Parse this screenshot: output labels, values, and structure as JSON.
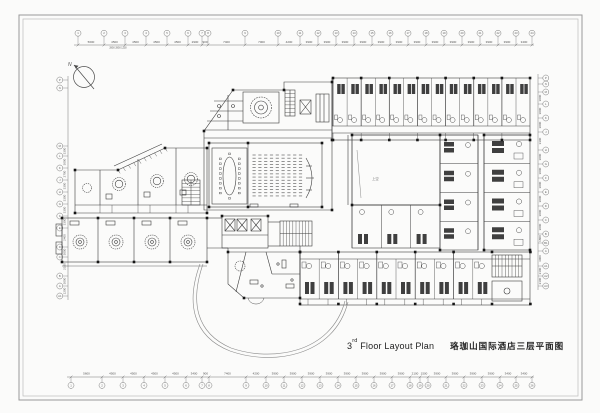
{
  "title": {
    "en_num": "3",
    "en_sup": "rd",
    "en_rest": " Floor Layout Plan",
    "cn": "珞珈山国际酒店三层平面图"
  },
  "north": {
    "label": "N"
  },
  "labels": {
    "atrium": "上空",
    "sub_dims": "2850 2850 1250"
  },
  "colors": {
    "line": "#3d3d3d",
    "dim": "#666666",
    "frame": "#9a9a9a",
    "bed": "#3f3f3f"
  },
  "grids": {
    "top_labels": [
      "1",
      "2",
      "3",
      "4",
      "5",
      "6",
      "7",
      "8",
      "9",
      "10",
      "11",
      "12",
      "13",
      "14",
      "15",
      "16",
      "17",
      "18",
      "19",
      "20",
      "21",
      "22",
      "23",
      "24"
    ],
    "bottom_labels": [
      "1",
      "2",
      "3",
      "4",
      "5",
      "6",
      "7",
      "8",
      "9",
      "10",
      "11",
      "12",
      "13",
      "14",
      "15",
      "16",
      "17",
      "18",
      "19",
      "20",
      "21",
      "22",
      "23",
      "24",
      "25",
      "26"
    ],
    "left_labels": [
      "P",
      "N",
      "M",
      "L",
      "K",
      "J",
      "H",
      "G",
      "F",
      "E",
      "D",
      "C",
      "B",
      "A",
      "A1"
    ],
    "right_labels": [
      "P",
      "N",
      "M",
      "L",
      "K",
      "J",
      "H",
      "G",
      "F",
      "E",
      "D",
      "C",
      "B",
      "B1",
      "A",
      "A1",
      "A2",
      "A3"
    ]
  },
  "dimensions": {
    "top": [
      "5600",
      "4500",
      "4500",
      "4500",
      "4500",
      "2900",
      "900",
      "7400",
      "7000",
      "4200",
      "3900",
      "3900",
      "3900",
      "3900",
      "3900",
      "3900",
      "3900",
      "3900",
      "3900",
      "3900",
      "3900",
      "3900",
      "3400"
    ],
    "bottom": [
      "5600",
      "4500",
      "4500",
      "4500",
      "4500",
      "3400",
      "900",
      "7400",
      "4200",
      "3900",
      "3900",
      "3900",
      "3900",
      "3900",
      "3900",
      "3900",
      "3900",
      "2100",
      "1500",
      "3900",
      "3900",
      "3900",
      "3900",
      "3400",
      "3400"
    ],
    "left": [
      "",
      "",
      "3300",
      "3000",
      "2700",
      "3300",
      "3300",
      "3300",
      "3300",
      "2400",
      "3000",
      "2100",
      "3000",
      "1200"
    ],
    "right": [
      "",
      "",
      "3000",
      "3000",
      "3000",
      "3300",
      "3000",
      "3000",
      "3000",
      "3000",
      "3000",
      "3000",
      "1800",
      "",
      "3000",
      "2100",
      "2100"
    ]
  },
  "rooms": {
    "top_row_modules": 7,
    "bottom_row_modules": 5,
    "right_wing_modules": 4,
    "mid_wing_modules": 4,
    "under_atrium_rooms": 3,
    "theater_columns": 9,
    "theater_rows": 14
  }
}
